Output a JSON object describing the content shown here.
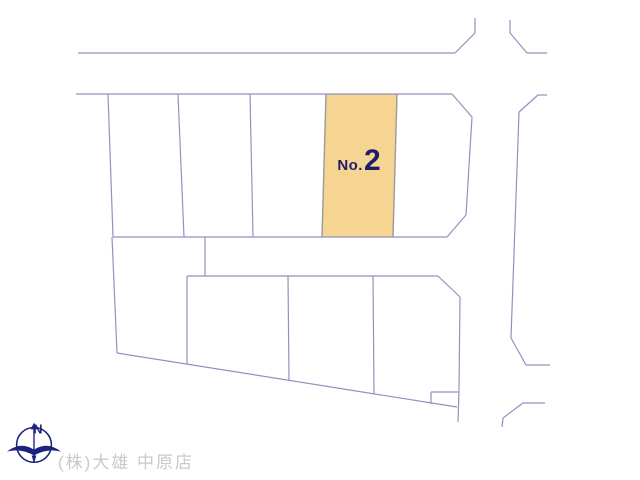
{
  "map": {
    "colors": {
      "line": "#9191c1",
      "parcel_fill": "#f6d593",
      "parcel_border": "#9a9a9a",
      "label": "#1d1d6b",
      "logo": "#1a237e",
      "company_text": "#c9c9c9"
    },
    "line_segments": [
      [
        78,
        53,
        455,
        53
      ],
      [
        455,
        53,
        475,
        33
      ],
      [
        475,
        33,
        475,
        18
      ],
      [
        510,
        20,
        510,
        33
      ],
      [
        510,
        33,
        527,
        53
      ],
      [
        527,
        53,
        547,
        53
      ],
      [
        76,
        94,
        452,
        94
      ],
      [
        452,
        94,
        472,
        117
      ],
      [
        472,
        117,
        466,
        215
      ],
      [
        466,
        215,
        447,
        237
      ],
      [
        538,
        95,
        547,
        95
      ],
      [
        538,
        95,
        519,
        112
      ],
      [
        519,
        112,
        511,
        338
      ],
      [
        511,
        338,
        526,
        365
      ],
      [
        526,
        365,
        550,
        365
      ],
      [
        545,
        403,
        523,
        403
      ],
      [
        523,
        403,
        503,
        418
      ],
      [
        503,
        418,
        502,
        427
      ],
      [
        108,
        94,
        113,
        237
      ],
      [
        113,
        237,
        447,
        237
      ],
      [
        178,
        94,
        184,
        237
      ],
      [
        250,
        94,
        253,
        237
      ],
      [
        205,
        237,
        205,
        276
      ],
      [
        187,
        276,
        438,
        276
      ],
      [
        112,
        237,
        117,
        353
      ],
      [
        187,
        276,
        187,
        364
      ],
      [
        117,
        353,
        457,
        407
      ],
      [
        438,
        276,
        460,
        297
      ],
      [
        460,
        297,
        459,
        390
      ],
      [
        459,
        390,
        458,
        422
      ],
      [
        431,
        392,
        458,
        392
      ],
      [
        431,
        392,
        431,
        404
      ],
      [
        288,
        276,
        289,
        380
      ],
      [
        373,
        276,
        374,
        394
      ]
    ],
    "highlight_parcel": {
      "points": "326,94 397,94 393,237 322,237",
      "side_borders": [
        [
          326,
          94,
          322,
          237
        ],
        [
          397,
          94,
          393,
          237
        ]
      ],
      "label_prefix": "No.",
      "label_number": "2"
    }
  },
  "compass": {
    "north_label": "N"
  },
  "footer": {
    "company": "(株)大雄 中原店"
  }
}
